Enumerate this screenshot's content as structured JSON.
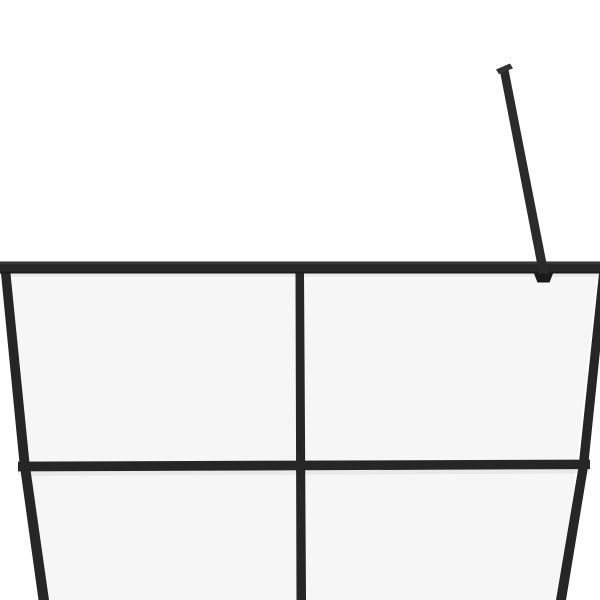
{
  "meta": {
    "description": "Product photo: walk-in shower screen with clear glass, black metal frame grid (top rail, middle rail, center mullion, slanted side profiles) and a diagonal support stabilizer arm, cropped close-up on a plain white background",
    "alt": "Black framed clear-glass shower wall panel, upper section with support bar"
  },
  "colors": {
    "background": "#ffffff",
    "glass": "#f6f6f7",
    "frame": "#262626",
    "frame_shadow_edge": "#1a1a1a",
    "frame_highlight": "#4a4a4a",
    "support_arm": "#2b2b2b",
    "wall_cap": "#333333"
  },
  "scene": {
    "glass_panel": {
      "points": "4,273 598,273 561,600 42,600"
    },
    "top_rail": {
      "points": "0,261.5 600,261.5 600,273.5 0,273.5"
    },
    "top_rail_highlight": {
      "points": "0,262.3 600,262.3 600,264.3 0,264.3"
    },
    "top_rail_bottom_edge": {
      "points": "0,271.8 600,271.8 600,273.5 0,273.5"
    },
    "top_rail_shadow": {
      "points": "0,273.5 600,273.5 600,276.8 0,276.8"
    },
    "left_frame_edge": {
      "points": "1,273.5 10.5,273.5 29.5,463 49,600 38.5,600 19.5,463"
    },
    "right_frame_edge": {
      "points": "599,273.5 608,273.5 588,467 566,600 556,600 578.5,467"
    },
    "center_mullion": {
      "points": "295.5,273.5 304,273.5 306,600 296.5,600"
    },
    "middle_rail": {
      "points": "18,461.6 590,459.6 590,469.1 18,471.4"
    },
    "middle_rail_shadow": {
      "points": "18,471.4 590,469.1 590,473.5 18,476"
    },
    "support_arm": {
      "points": "499.5,69 508,67 548.5,273.5 539,273.5"
    },
    "support_arm_wall_cap": {
      "points": "496,69.5 510,63.5 513,68.2 499,74.2"
    },
    "support_arm_clamp": {
      "points": "534,273.5 553,273.5 549.5,282.5 537.5,282.5"
    }
  }
}
